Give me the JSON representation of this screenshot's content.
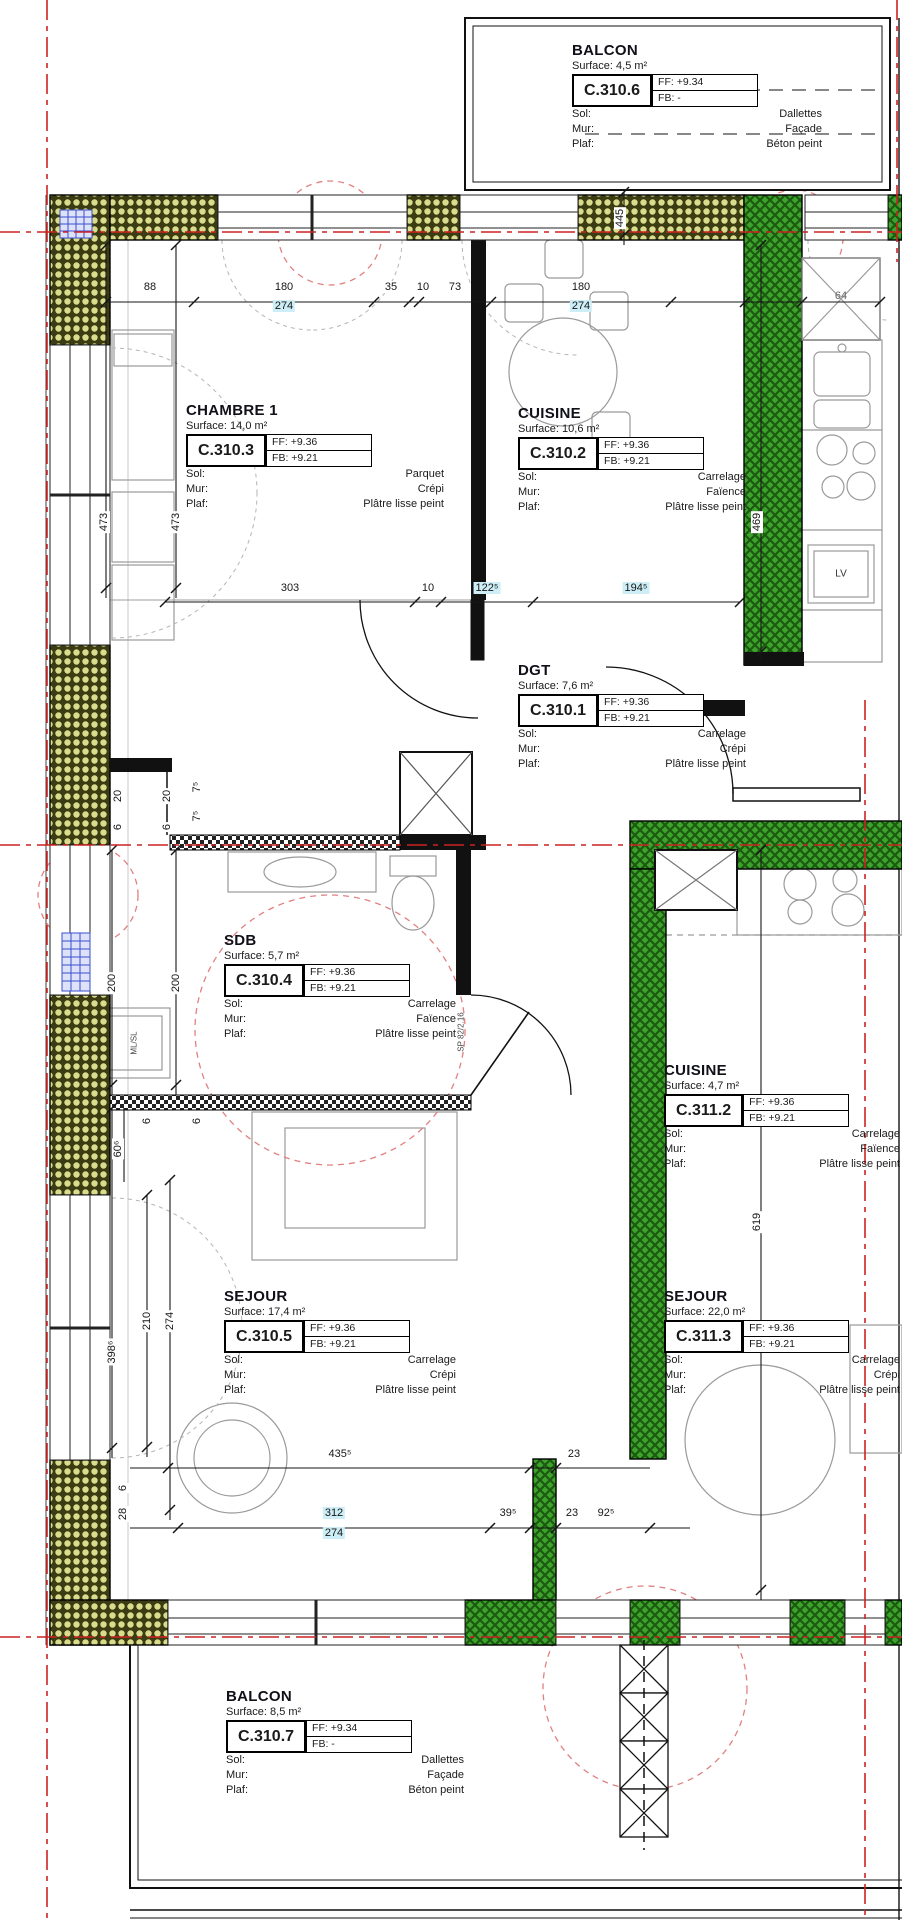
{
  "field_labels": {
    "sol": "Sol:",
    "mur": "Mur:",
    "plaf": "Plaf:"
  },
  "rooms": [
    {
      "name": "BALCON",
      "surface": "Surface: 4,5 m²",
      "code": "C.310.6",
      "ff": "FF: +9.34",
      "fb": "FB: -",
      "sol": "Dallettes",
      "mur": "Façade",
      "plaf": "Béton peint"
    },
    {
      "name": "CHAMBRE 1",
      "surface": "Surface: 14,0 m²",
      "code": "C.310.3",
      "ff": "FF: +9.36",
      "fb": "FB: +9.21",
      "sol": "Parquet",
      "mur": "Crépi",
      "plaf": "Plâtre lisse peint"
    },
    {
      "name": "CUISINE",
      "surface": "Surface: 10,6 m²",
      "code": "C.310.2",
      "ff": "FF: +9.36",
      "fb": "FB: +9.21",
      "sol": "Carrelage",
      "mur": "Faïence",
      "plaf": "Plâtre lisse peint"
    },
    {
      "name": "DGT",
      "surface": "Surface: 7,6 m²",
      "code": "C.310.1",
      "ff": "FF: +9.36",
      "fb": "FB: +9.21",
      "sol": "Carrelage",
      "mur": "Crépi",
      "plaf": "Plâtre lisse peint"
    },
    {
      "name": "SDB",
      "surface": "Surface: 5,7 m²",
      "code": "C.310.4",
      "ff": "FF: +9.36",
      "fb": "FB: +9.21",
      "sol": "Carrelage",
      "mur": "Faïence",
      "plaf": "Plâtre lisse peint"
    },
    {
      "name": "SEJOUR",
      "surface": "Surface: 17,4 m²",
      "code": "C.310.5",
      "ff": "FF: +9.36",
      "fb": "FB: +9.21",
      "sol": "Carrelage",
      "mur": "Crépi",
      "plaf": "Plâtre lisse peint"
    },
    {
      "name": "CUISINE",
      "surface": "Surface: 4,7 m²",
      "code": "C.311.2",
      "ff": "FF: +9.36",
      "fb": "FB: +9.21",
      "sol": "Carrelage",
      "mur": "Faïence",
      "plaf": "Plâtre lisse peint"
    },
    {
      "name": "SEJOUR",
      "surface": "Surface: 22,0 m²",
      "code": "C.311.3",
      "ff": "FF: +9.36",
      "fb": "FB: +9.21",
      "sol": "Carrelage",
      "mur": "Crépi",
      "plaf": "Plâtre lisse peint"
    },
    {
      "name": "BALCON",
      "surface": "Surface: 8,5 m²",
      "code": "C.310.7",
      "ff": "FF: +9.34",
      "fb": "FB: -",
      "sol": "Dallettes",
      "mur": "Façade",
      "plaf": "Béton peint"
    }
  ],
  "dims": {
    "top": [
      "88",
      "180",
      "274",
      "35",
      "10",
      "73",
      "180",
      "274",
      "64"
    ],
    "middle": [
      "303",
      "10",
      "122⁵",
      "194⁵"
    ],
    "bottom_upper": [
      "435⁵",
      "23"
    ],
    "bottom_lower": [
      "312",
      "274",
      "39⁵",
      "23",
      "92⁵"
    ],
    "left": [
      "473",
      "473",
      "20",
      "6",
      "20",
      "6",
      "7⁵",
      "7⁵",
      "200",
      "200",
      "60⁶",
      "6",
      "6",
      "210",
      "274",
      "398⁶",
      "6",
      "28"
    ],
    "right": [
      "445",
      "469",
      "619"
    ]
  },
  "annotations": {
    "lv": "LV",
    "washer": "ML/SL",
    "sdb_door": "SP 82/2.16"
  },
  "colors": {
    "axis_red": "#cc2222",
    "wall_green": "#3da32c",
    "wall_hatch_yellow": "#d9db8d",
    "furniture_gray": "#9a9a9a",
    "grille_blue": "#3a4fd0",
    "highlight_cyan": "#cdeef6"
  }
}
